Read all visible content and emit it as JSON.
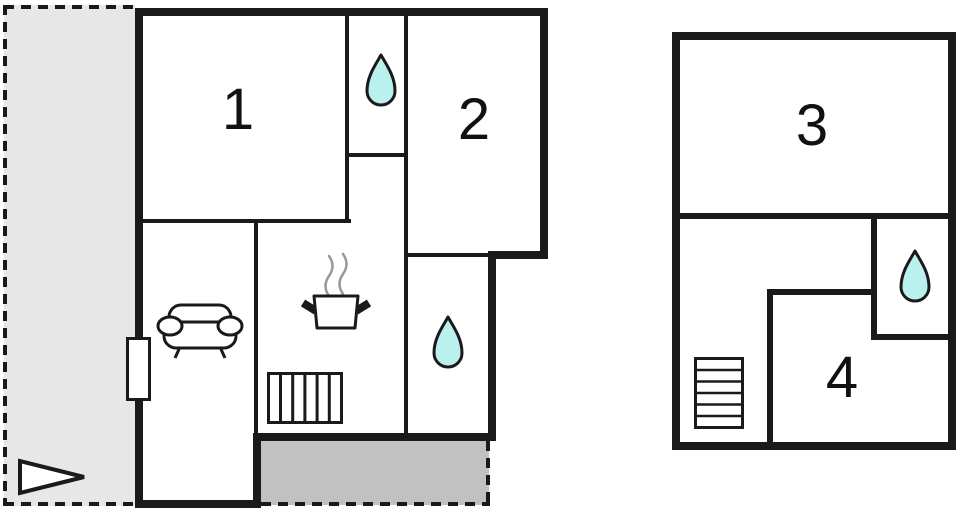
{
  "floorplan": {
    "title": "Holiday house floor plan",
    "buildings": [
      {
        "name": "ground-floor",
        "rooms": [
          {
            "number": "1"
          },
          {
            "number": "2"
          }
        ],
        "features": [
          "water-drop",
          "water-drop",
          "sofa",
          "cooking-pot",
          "stairs",
          "door",
          "patio",
          "terrace",
          "direction-arrow"
        ]
      },
      {
        "name": "upper-floor",
        "rooms": [
          {
            "number": "3"
          },
          {
            "number": "4"
          }
        ],
        "features": [
          "water-drop",
          "stairs"
        ]
      }
    ],
    "colors": {
      "wall": "#1a1a1a",
      "terrace_light": "#e7e7e7",
      "terrace_dark": "#c1c1c1",
      "water_drop": "#baf1ee",
      "steam": "#999999"
    }
  }
}
